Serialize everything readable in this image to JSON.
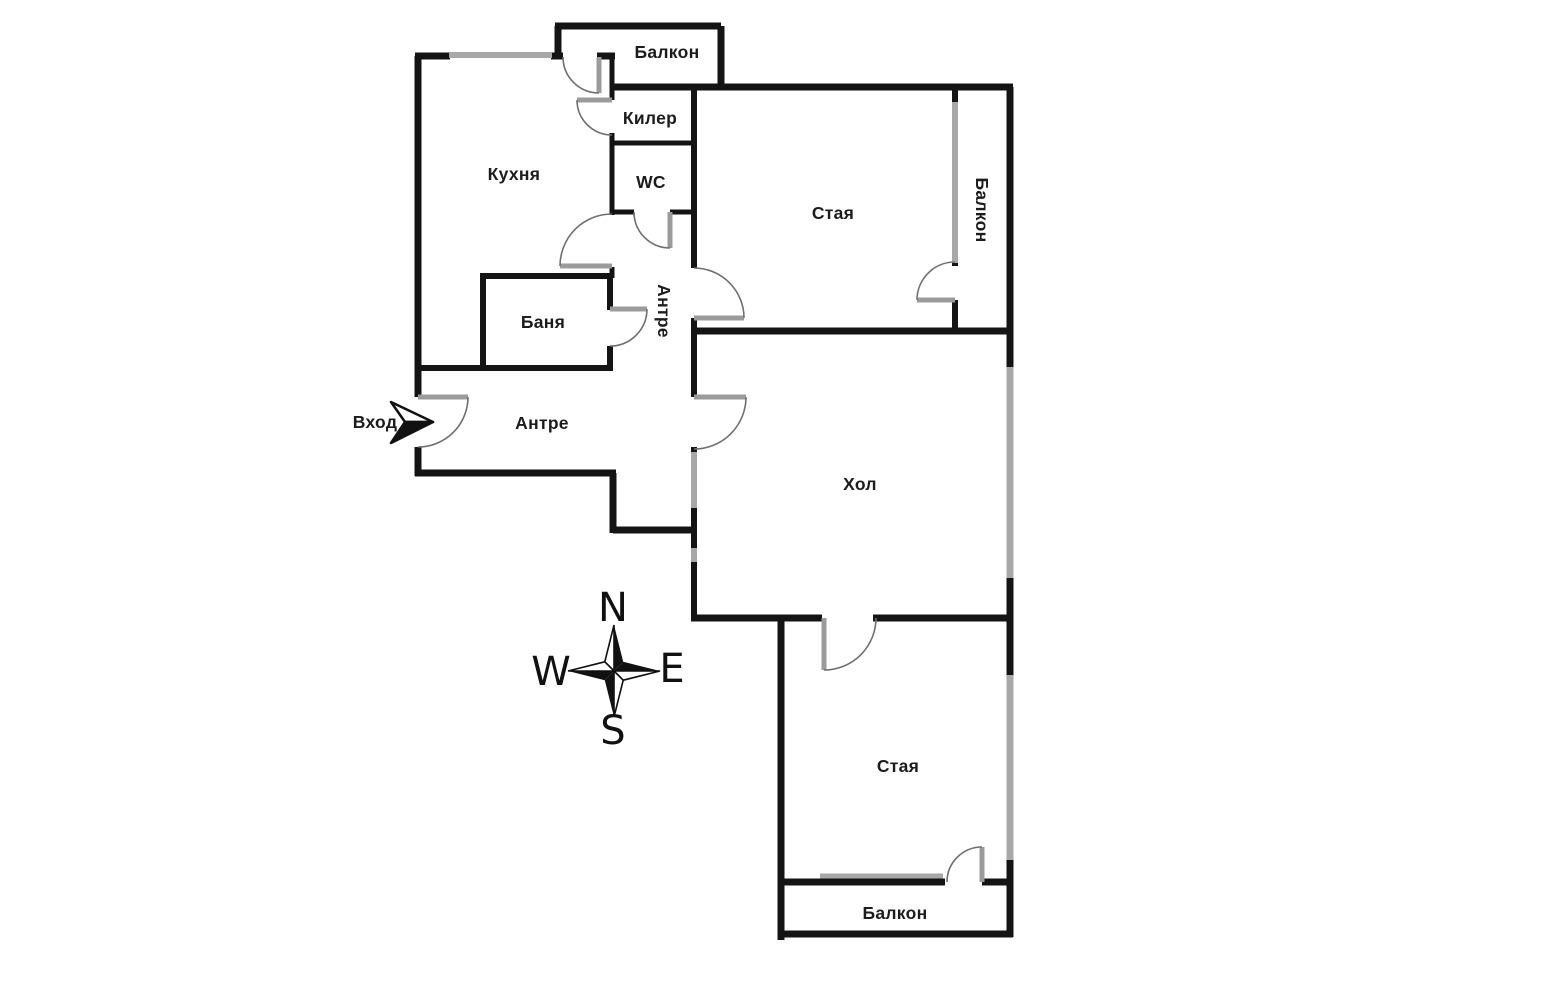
{
  "plan": {
    "labels": {
      "balcony_top": "Балкон",
      "closet": "Килер",
      "wc": "WC",
      "kitchen": "Кухня",
      "room_top": "Стая",
      "balcony_right": "Балкон",
      "corridor": "Антре",
      "bathroom": "Баня",
      "entry_hall": "Антре",
      "entrance": "Вход",
      "living_room": "Хол",
      "room_bottom": "Стая",
      "balcony_bottom": "Балкон"
    },
    "compass": {
      "north": "N",
      "east": "E",
      "south": "S",
      "west": "W"
    },
    "colors": {
      "wall": "#141414",
      "window": "#a8a8a8",
      "door_leaf": "#9b9b9b",
      "door_arc": "#6f6f6f",
      "background": "#ffffff"
    }
  }
}
